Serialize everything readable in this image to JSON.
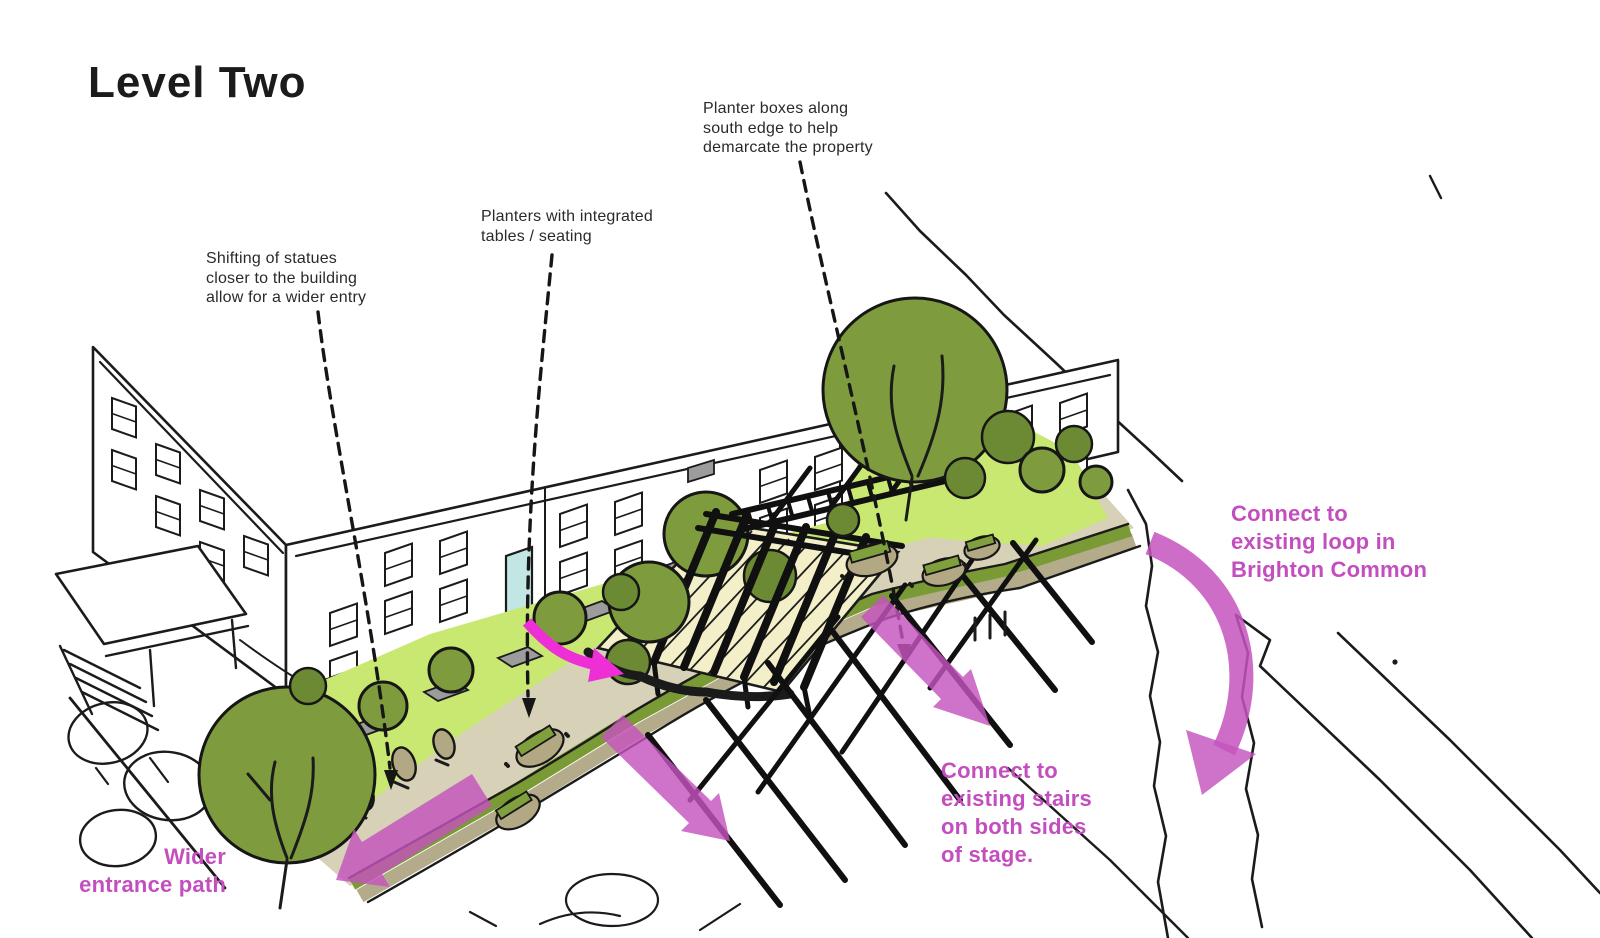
{
  "title": "Level Two",
  "notes": {
    "planter_boxes": {
      "text": "Planter boxes along\nsouth edge to help\ndemarcate the property"
    },
    "planters": {
      "text": "Planters with integrated\ntables / seating"
    },
    "statues": {
      "text": "Shifting of statues\ncloser to the building\nallow for a wider entry"
    }
  },
  "callouts": {
    "connect_loop": {
      "text": "Connect to\nexisting loop in\nBrighton Common"
    },
    "connect_stairs": {
      "text": "Connect to\nexisting stairs\non both sides\nof stage."
    },
    "wider_entrance": {
      "text": "Wider\nentrance path"
    }
  },
  "colors": {
    "pink_text": "#c34fbe",
    "arrow_pink": "#c553bd",
    "arrow_bright": "#ee2fd6",
    "lawn": "#c9e872",
    "tree": "#7e9c3e",
    "tree_dark": "#6c8a33",
    "tan": "#d7d1b8",
    "hedge_tan": "#b4ab8a",
    "hedge_green": "#7a9a35",
    "cream": "#f3efc9",
    "paver": "#9c9c9c",
    "door": "#c2e6e4",
    "statue": "#b2a883",
    "bench_slat": "#7fa03c"
  }
}
